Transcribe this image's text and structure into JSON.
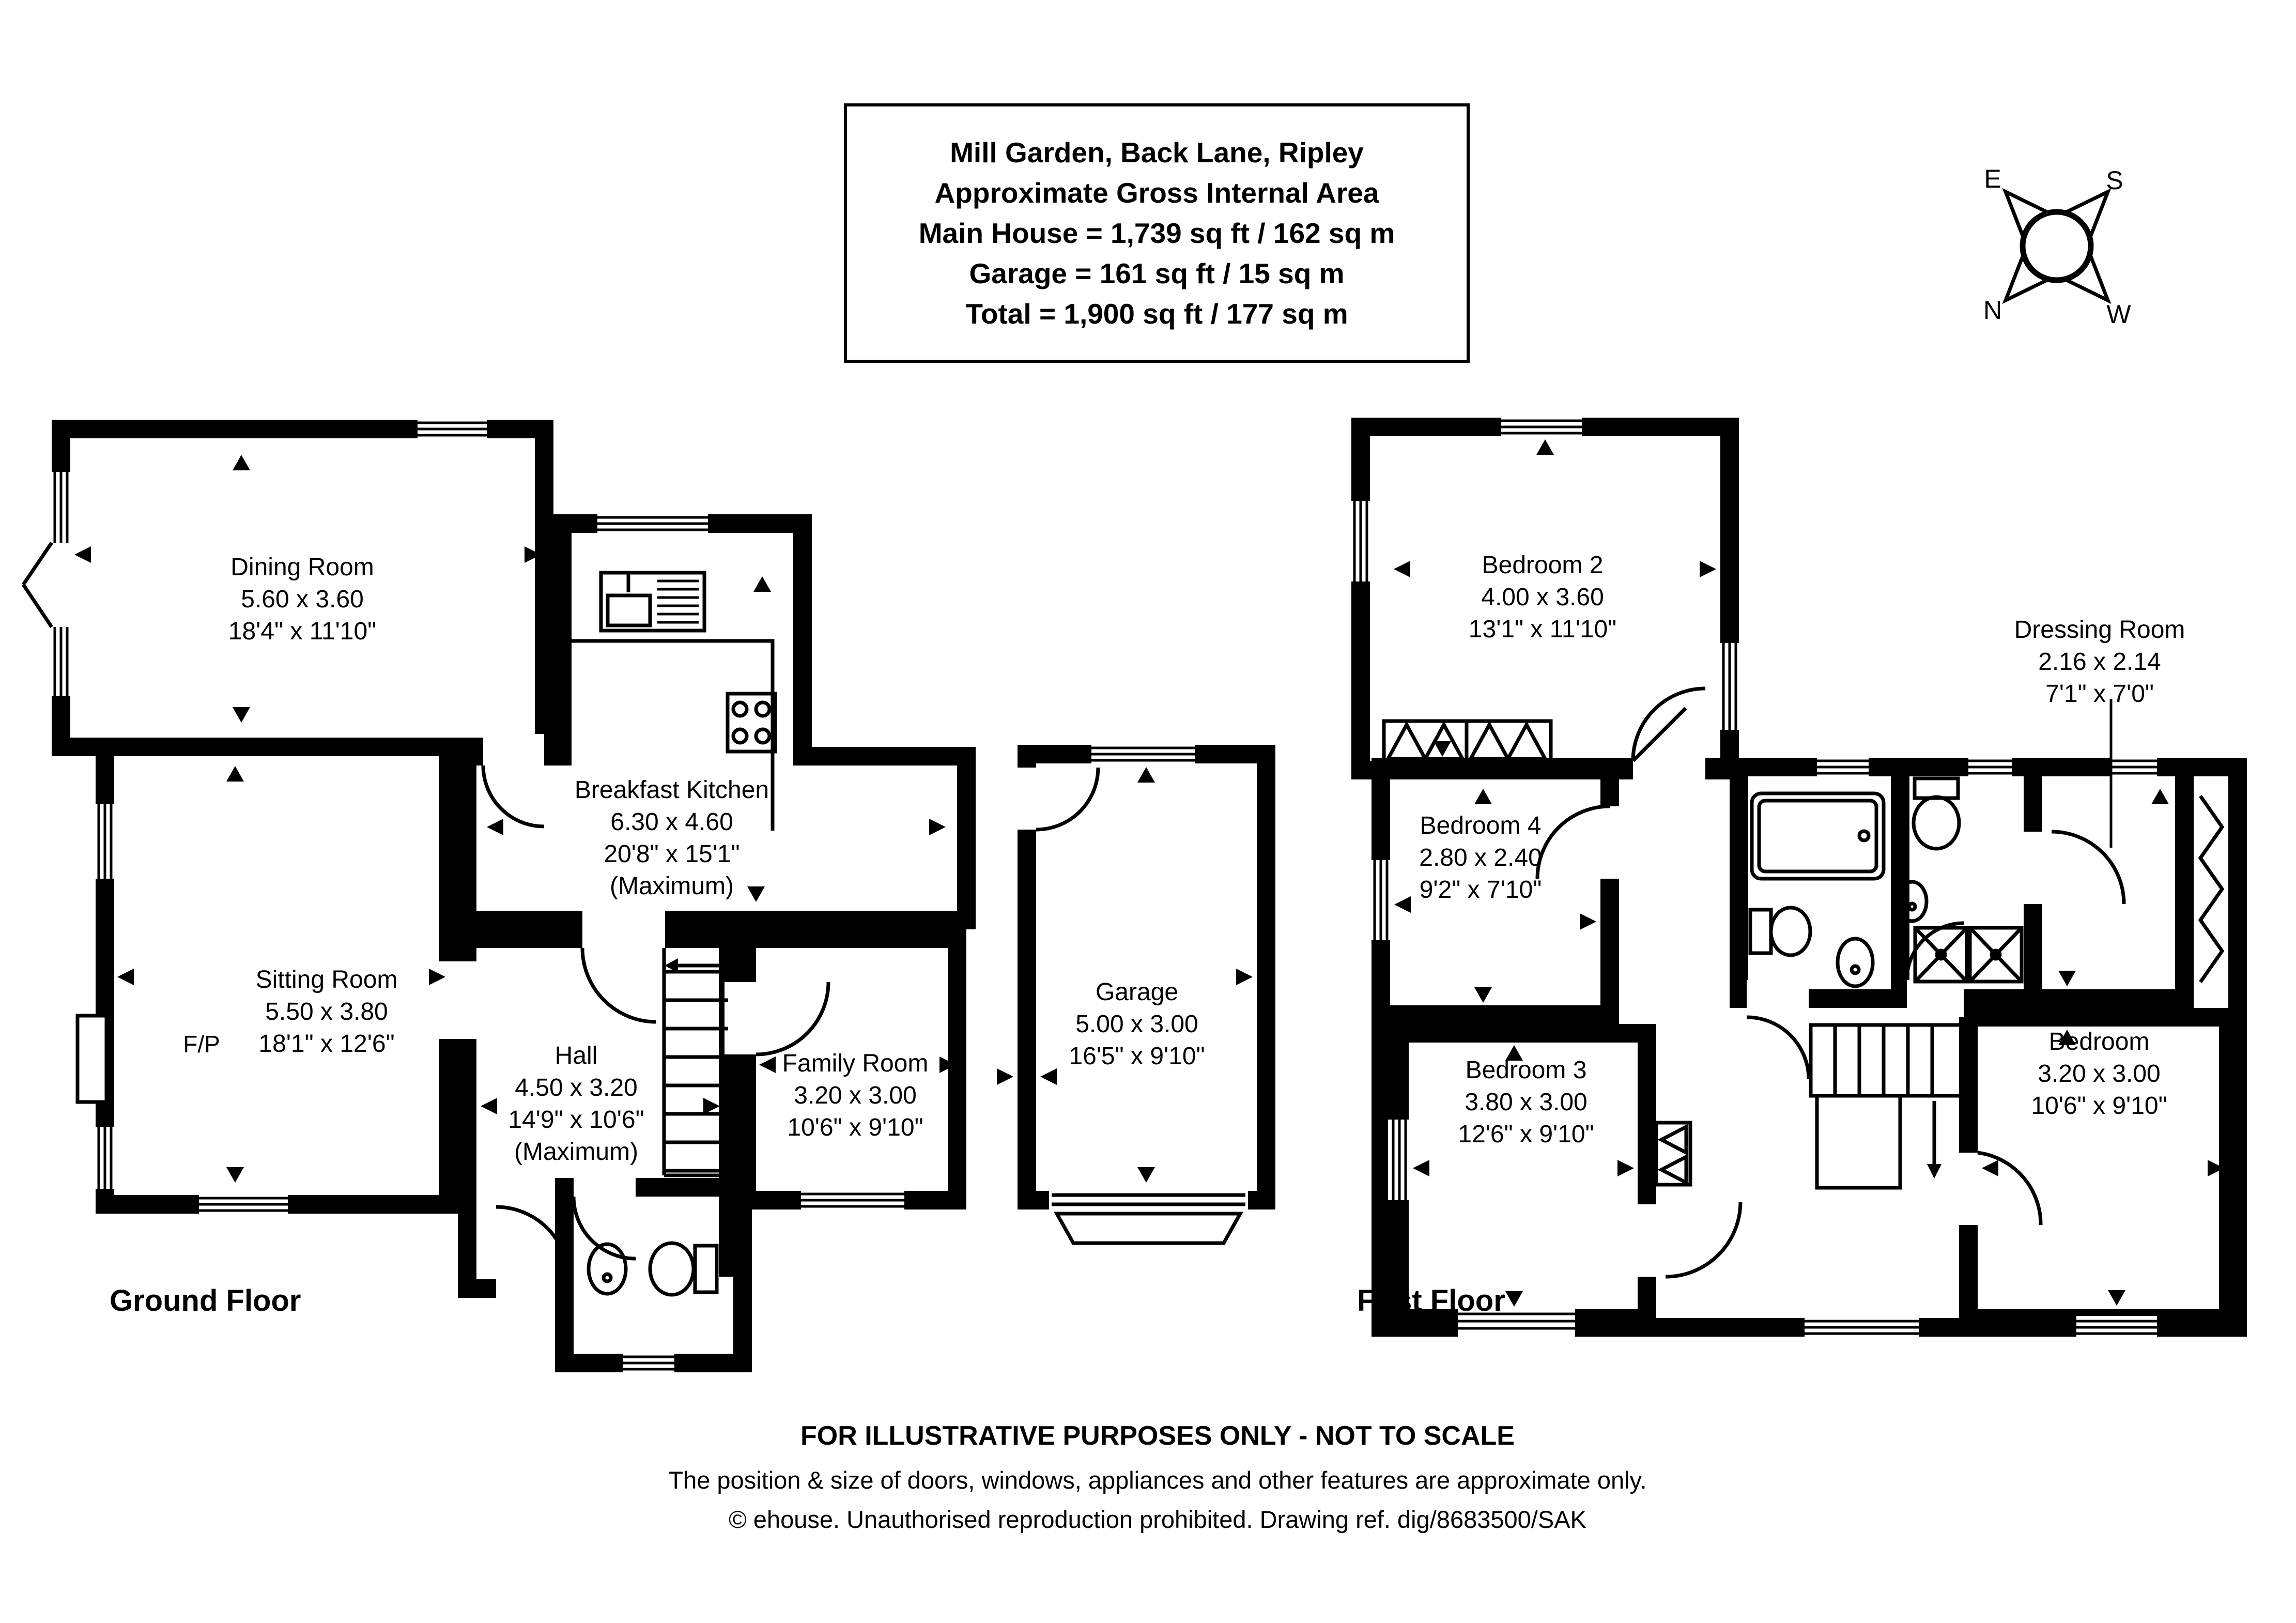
{
  "title_block": {
    "address": "Mill Garden, Back Lane, Ripley",
    "subtitle": "Approximate Gross Internal Area",
    "main_house": "Main House = 1,739 sq ft / 162 sq m",
    "garage": "Garage = 161 sq ft / 15 sq m",
    "total": "Total = 1,900 sq ft / 177 sq m"
  },
  "compass": {
    "north": "N",
    "east": "E",
    "south": "S",
    "west": "W"
  },
  "ground_floor": {
    "label": "Ground Floor",
    "fireplace_label": "F/P",
    "rooms": {
      "dining": {
        "name": "Dining Room",
        "metric": "5.60 x 3.60",
        "imperial": "18'4\" x 11'10\""
      },
      "sitting": {
        "name": "Sitting Room",
        "metric": "5.50 x 3.80",
        "imperial": "18'1\" x 12'6\""
      },
      "breakfast": {
        "name": "Breakfast Kitchen",
        "metric": "6.30 x 4.60",
        "imperial": "20'8\" x 15'1\"",
        "note": "(Maximum)"
      },
      "hall": {
        "name": "Hall",
        "metric": "4.50 x 3.20",
        "imperial": "14'9\" x 10'6\"",
        "note": "(Maximum)"
      },
      "family": {
        "name": "Family Room",
        "metric": "3.20 x 3.00",
        "imperial": "10'6\" x 9'10\""
      },
      "garage": {
        "name": "Garage",
        "metric": "5.00 x 3.00",
        "imperial": "16'5\" x 9'10\""
      }
    }
  },
  "first_floor": {
    "label": "First Floor",
    "rooms": {
      "bedroom2": {
        "name": "Bedroom 2",
        "metric": "4.00 x 3.60",
        "imperial": "13'1\" x 11'10\""
      },
      "bedroom4": {
        "name": "Bedroom 4",
        "metric": "2.80 x 2.40",
        "imperial": "9'2\" x 7'10\""
      },
      "bedroom3": {
        "name": "Bedroom 3",
        "metric": "3.80 x 3.00",
        "imperial": "12'6\" x 9'10\""
      },
      "dressing": {
        "name": "Dressing Room",
        "metric": "2.16 x 2.14",
        "imperial": "7'1\" x 7'0\""
      },
      "principal": {
        "name": "Principal Bedroom",
        "metric": "3.20 x 3.00",
        "imperial": "10'6\" x 9'10\""
      }
    }
  },
  "footer": {
    "line1": "FOR ILLUSTRATIVE PURPOSES ONLY - NOT TO SCALE",
    "line2": "The position & size of doors, windows, appliances and other features are approximate only.",
    "line3": "© ehouse. Unauthorised reproduction prohibited. Drawing ref. dig/8683500/SAK"
  }
}
